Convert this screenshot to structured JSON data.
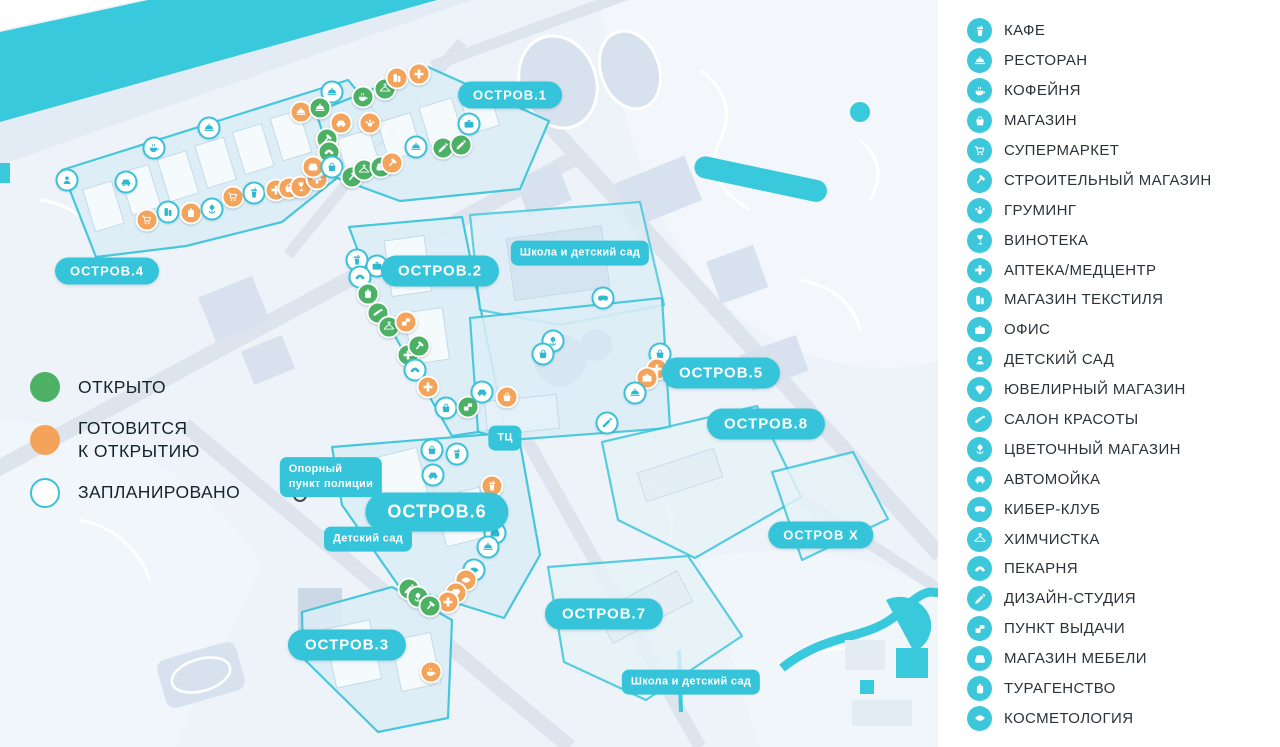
{
  "colors": {
    "accent_teal": "#35c4d9",
    "water": "#38c9dc",
    "open_green": "#4cb164",
    "soon_orange": "#f3a35a",
    "planned_ring": "#3ac3d8"
  },
  "status_legend": {
    "items": [
      {
        "status": "open",
        "label": "ОТКРЫТО"
      },
      {
        "status": "soon",
        "label": "ГОТОВИТСЯ\nК ОТКРЫТИЮ"
      },
      {
        "status": "planned",
        "label": "ЗАПЛАНИРОВАНО"
      }
    ]
  },
  "legend": {
    "items": [
      {
        "icon": "cafe",
        "label": "КАФЕ"
      },
      {
        "icon": "restaurant",
        "label": "РЕСТОРАН"
      },
      {
        "icon": "coffee",
        "label": "КОФЕЙНЯ"
      },
      {
        "icon": "basket",
        "label": "МАГАЗИН"
      },
      {
        "icon": "cart",
        "label": "СУПЕРМАРКЕТ"
      },
      {
        "icon": "hammer",
        "label": "СТРОИТЕЛЬНЫЙ МАГАЗИН"
      },
      {
        "icon": "paw",
        "label": "ГРУМИНГ"
      },
      {
        "icon": "wine",
        "label": "ВИНОТЕКА"
      },
      {
        "icon": "cross",
        "label": "АПТЕКА/МЕДЦЕНТР"
      },
      {
        "icon": "textile",
        "label": "МАГАЗИН ТЕКСТИЛЯ"
      },
      {
        "icon": "office",
        "label": "ОФИС"
      },
      {
        "icon": "kindergarten",
        "label": "ДЕТСКИЙ САД"
      },
      {
        "icon": "diamond",
        "label": "ЮВЕЛИРНЫЙ МАГАЗИН"
      },
      {
        "icon": "beauty",
        "label": "САЛОН КРАСОТЫ"
      },
      {
        "icon": "flower",
        "label": "ЦВЕТОЧНЫЙ МАГАЗИН"
      },
      {
        "icon": "carwash",
        "label": "АВТОМОЙКА"
      },
      {
        "icon": "cyber",
        "label": "КИБЕР-КЛУБ"
      },
      {
        "icon": "drycleaning",
        "label": "ХИМЧИСТКА"
      },
      {
        "icon": "bakery",
        "label": "ПЕКАРНЯ"
      },
      {
        "icon": "design",
        "label": "ДИЗАЙН-СТУДИЯ"
      },
      {
        "icon": "pickup",
        "label": "ПУНКТ ВЫДАЧИ"
      },
      {
        "icon": "furniture",
        "label": "МАГАЗИН МЕБЕЛИ"
      },
      {
        "icon": "travel",
        "label": "ТУРАГЕНСТВО"
      },
      {
        "icon": "cosmetology",
        "label": "КОСМЕТОЛОГИЯ"
      }
    ]
  },
  "map": {
    "island_labels": [
      {
        "label": "ОСТРОВ.1",
        "x": 510,
        "y": 95,
        "size": "sm"
      },
      {
        "label": "ОСТРОВ.2",
        "x": 440,
        "y": 271,
        "size": "md"
      },
      {
        "label": "ОСТРОВ.3",
        "x": 347,
        "y": 645,
        "size": "md"
      },
      {
        "label": "ОСТРОВ.4",
        "x": 107,
        "y": 271,
        "size": "sm"
      },
      {
        "label": "ОСТРОВ.5",
        "x": 721,
        "y": 373,
        "size": "md"
      },
      {
        "label": "ОСТРОВ.6",
        "x": 437,
        "y": 512,
        "size": "lg"
      },
      {
        "label": "ОСТРОВ.7",
        "x": 604,
        "y": 614,
        "size": "md"
      },
      {
        "label": "ОСТРОВ.8",
        "x": 766,
        "y": 424,
        "size": "md"
      },
      {
        "label": "ОСТРОВ Х",
        "x": 821,
        "y": 535,
        "size": "sm"
      }
    ],
    "info_labels": [
      {
        "label": "Школа и детский сад",
        "x": 580,
        "y": 253
      },
      {
        "label": "Опорный\nпункт полиции",
        "x": 331,
        "y": 477
      },
      {
        "label": "Детский сад",
        "x": 368,
        "y": 539
      },
      {
        "label": "ТЦ",
        "x": 505,
        "y": 438
      },
      {
        "label": "Школа и детский сад",
        "x": 691,
        "y": 682
      }
    ],
    "police_point": {
      "x": 300,
      "y": 495
    },
    "markers": [
      {
        "x": 209,
        "y": 128,
        "status": "planned",
        "type": "restaurant"
      },
      {
        "x": 154,
        "y": 148,
        "status": "planned",
        "type": "coffee"
      },
      {
        "x": 126,
        "y": 182,
        "status": "planned",
        "type": "carwash"
      },
      {
        "x": 67,
        "y": 180,
        "status": "planned",
        "type": "kindergarten"
      },
      {
        "x": 147,
        "y": 220,
        "status": "soon",
        "type": "cart"
      },
      {
        "x": 168,
        "y": 212,
        "status": "planned",
        "type": "textile"
      },
      {
        "x": 191,
        "y": 213,
        "status": "soon",
        "type": "travel"
      },
      {
        "x": 212,
        "y": 209,
        "status": "planned",
        "type": "flower"
      },
      {
        "x": 233,
        "y": 197,
        "status": "soon",
        "type": "cart"
      },
      {
        "x": 254,
        "y": 193,
        "status": "planned",
        "type": "cafe"
      },
      {
        "x": 276,
        "y": 190,
        "status": "soon",
        "type": "cross"
      },
      {
        "x": 289,
        "y": 188,
        "status": "soon",
        "type": "basket"
      },
      {
        "x": 301,
        "y": 187,
        "status": "soon",
        "type": "wine"
      },
      {
        "x": 317,
        "y": 179,
        "status": "soon",
        "type": "cross"
      },
      {
        "x": 315,
        "y": 167,
        "status": "soon",
        "type": "bakery"
      },
      {
        "x": 301,
        "y": 112,
        "status": "soon",
        "type": "restaurant"
      },
      {
        "x": 332,
        "y": 92,
        "status": "planned",
        "type": "restaurant"
      },
      {
        "x": 363,
        "y": 97,
        "status": "open",
        "type": "coffee"
      },
      {
        "x": 385,
        "y": 89,
        "status": "open",
        "type": "drycleaning"
      },
      {
        "x": 397,
        "y": 78,
        "status": "soon",
        "type": "textile"
      },
      {
        "x": 419,
        "y": 74,
        "status": "soon",
        "type": "cross"
      },
      {
        "x": 320,
        "y": 108,
        "status": "open",
        "type": "restaurant"
      },
      {
        "x": 341,
        "y": 123,
        "status": "soon",
        "type": "carwash"
      },
      {
        "x": 370,
        "y": 123,
        "status": "soon",
        "type": "paw"
      },
      {
        "x": 327,
        "y": 139,
        "status": "open",
        "type": "hammer"
      },
      {
        "x": 329,
        "y": 152,
        "status": "open",
        "type": "bakery"
      },
      {
        "x": 313,
        "y": 167,
        "status": "soon",
        "type": "furniture"
      },
      {
        "x": 332,
        "y": 167,
        "status": "planned",
        "type": "basket"
      },
      {
        "x": 352,
        "y": 177,
        "status": "open",
        "type": "hammer"
      },
      {
        "x": 364,
        "y": 170,
        "status": "open",
        "type": "drycleaning"
      },
      {
        "x": 381,
        "y": 167,
        "status": "open",
        "type": "furniture"
      },
      {
        "x": 392,
        "y": 163,
        "status": "soon",
        "type": "hammer"
      },
      {
        "x": 416,
        "y": 147,
        "status": "planned",
        "type": "restaurant"
      },
      {
        "x": 443,
        "y": 148,
        "status": "open",
        "type": "design"
      },
      {
        "x": 461,
        "y": 145,
        "status": "open",
        "type": "design"
      },
      {
        "x": 469,
        "y": 124,
        "status": "planned",
        "type": "office"
      },
      {
        "x": 357,
        "y": 260,
        "status": "planned",
        "type": "cafe"
      },
      {
        "x": 377,
        "y": 266,
        "status": "planned",
        "type": "office"
      },
      {
        "x": 360,
        "y": 277,
        "status": "planned",
        "type": "bakery"
      },
      {
        "x": 368,
        "y": 294,
        "status": "open",
        "type": "travel"
      },
      {
        "x": 378,
        "y": 313,
        "status": "open",
        "type": "beauty"
      },
      {
        "x": 389,
        "y": 327,
        "status": "open",
        "type": "drycleaning"
      },
      {
        "x": 406,
        "y": 322,
        "status": "soon",
        "type": "pickup"
      },
      {
        "x": 408,
        "y": 355,
        "status": "open",
        "type": "cross"
      },
      {
        "x": 419,
        "y": 346,
        "status": "open",
        "type": "hammer"
      },
      {
        "x": 415,
        "y": 370,
        "status": "planned",
        "type": "bakery"
      },
      {
        "x": 428,
        "y": 387,
        "status": "soon",
        "type": "cross"
      },
      {
        "x": 446,
        "y": 408,
        "status": "planned",
        "type": "basket"
      },
      {
        "x": 468,
        "y": 407,
        "status": "open",
        "type": "pickup"
      },
      {
        "x": 482,
        "y": 392,
        "status": "planned",
        "type": "carwash"
      },
      {
        "x": 507,
        "y": 397,
        "status": "soon",
        "type": "basket"
      },
      {
        "x": 603,
        "y": 298,
        "status": "planned",
        "type": "cyber"
      },
      {
        "x": 553,
        "y": 341,
        "status": "planned",
        "type": "flower"
      },
      {
        "x": 543,
        "y": 354,
        "status": "planned",
        "type": "basket"
      },
      {
        "x": 660,
        "y": 354,
        "status": "planned",
        "type": "basket"
      },
      {
        "x": 657,
        "y": 369,
        "status": "soon",
        "type": "cross"
      },
      {
        "x": 647,
        "y": 378,
        "status": "soon",
        "type": "office"
      },
      {
        "x": 635,
        "y": 393,
        "status": "planned",
        "type": "restaurant"
      },
      {
        "x": 607,
        "y": 423,
        "status": "planned",
        "type": "design"
      },
      {
        "x": 432,
        "y": 450,
        "status": "planned",
        "type": "basket"
      },
      {
        "x": 457,
        "y": 454,
        "status": "planned",
        "type": "cafe"
      },
      {
        "x": 433,
        "y": 475,
        "status": "planned",
        "type": "carwash"
      },
      {
        "x": 492,
        "y": 486,
        "status": "soon",
        "type": "cafe"
      },
      {
        "x": 495,
        "y": 533,
        "status": "planned",
        "type": "furniture"
      },
      {
        "x": 488,
        "y": 547,
        "status": "planned",
        "type": "restaurant"
      },
      {
        "x": 474,
        "y": 570,
        "status": "planned",
        "type": "cosmetology"
      },
      {
        "x": 466,
        "y": 580,
        "status": "soon",
        "type": "cosmetology"
      },
      {
        "x": 456,
        "y": 593,
        "status": "soon",
        "type": "diamond"
      },
      {
        "x": 448,
        "y": 602,
        "status": "soon",
        "type": "cross"
      },
      {
        "x": 409,
        "y": 589,
        "status": "open",
        "type": "design"
      },
      {
        "x": 418,
        "y": 597,
        "status": "open",
        "type": "flower"
      },
      {
        "x": 430,
        "y": 606,
        "status": "open",
        "type": "hammer"
      },
      {
        "x": 431,
        "y": 672,
        "status": "soon",
        "type": "coffee"
      }
    ]
  }
}
